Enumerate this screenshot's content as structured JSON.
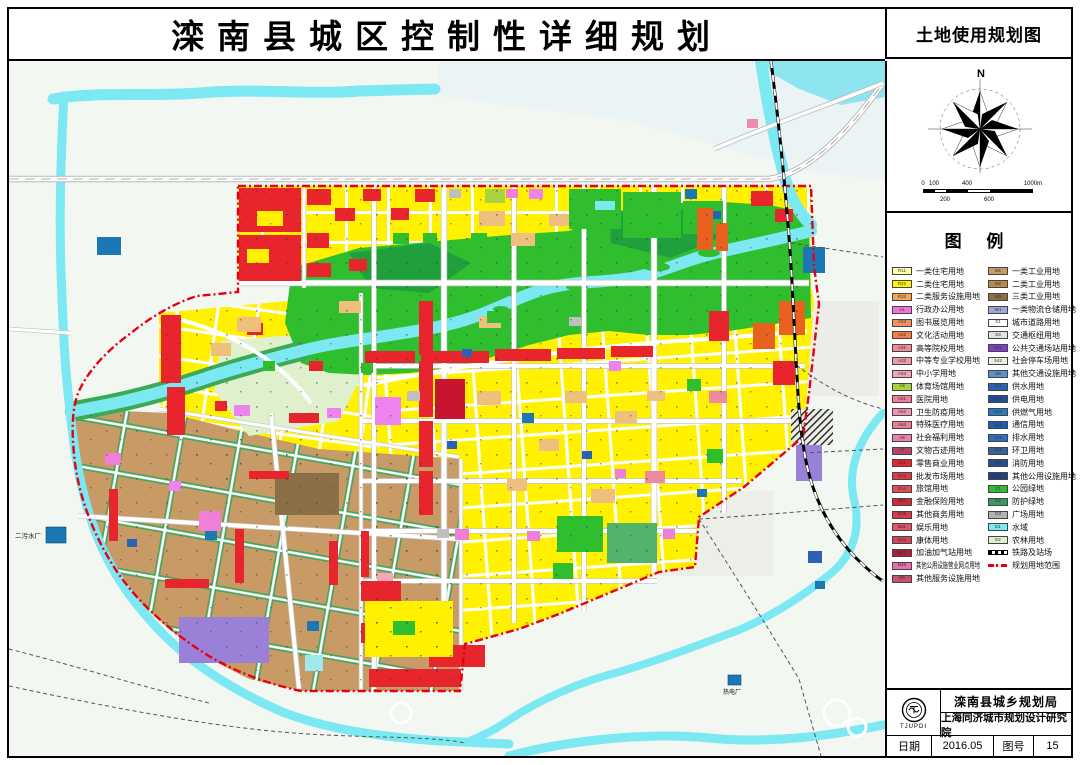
{
  "title": {
    "main": "滦南县城区控制性详细规划",
    "sub": "土地使用规划图"
  },
  "compass": {
    "north_label": "N"
  },
  "scale_bar": {
    "top_labels": [
      "0",
      "100",
      "400",
      "1000m"
    ],
    "bottom_labels": [
      "200",
      "600"
    ]
  },
  "legend": {
    "title": "图 例",
    "left_column": [
      {
        "code": "R11",
        "label": "一类住宅用地",
        "color": "#FFFFA8"
      },
      {
        "code": "R21",
        "label": "二类住宅用地",
        "color": "#FFF100"
      },
      {
        "code": "R22",
        "label": "二类服务设施用地",
        "color": "#F7A159"
      },
      {
        "code": "A1",
        "label": "行政办公用地",
        "color": "#F473D8"
      },
      {
        "code": "A23",
        "label": "图书展览用地",
        "color": "#F2925A"
      },
      {
        "code": "A22",
        "label": "文化活动用地",
        "color": "#F08146"
      },
      {
        "code": "A31",
        "label": "高等院校用地",
        "color": "#ED8A9C"
      },
      {
        "code": "A32",
        "label": "中等专业学校用地",
        "color": "#EF9AAB"
      },
      {
        "code": "A33",
        "label": "中小学用地",
        "color": "#F2A4B4"
      },
      {
        "code": "A4",
        "label": "体育场馆用地",
        "color": "#A8D23F"
      },
      {
        "code": "A51",
        "label": "医院用地",
        "color": "#EE7F9B"
      },
      {
        "code": "A52",
        "label": "卫生防疫用地",
        "color": "#F193B0"
      },
      {
        "code": "A53",
        "label": "特殊医疗用地",
        "color": "#E87F95"
      },
      {
        "code": "A6",
        "label": "社会福利用地",
        "color": "#EE7FAE"
      },
      {
        "code": "A7",
        "label": "文物古迹用地",
        "color": "#B5446B"
      },
      {
        "code": "B11",
        "label": "零售商业用地",
        "color": "#E8242D"
      },
      {
        "code": "B12",
        "label": "批发市场用地",
        "color": "#E03A42"
      },
      {
        "code": "B14",
        "label": "旅馆用地",
        "color": "#E04F57"
      },
      {
        "code": "B21",
        "label": "金融保险用地",
        "color": "#CE2A38"
      },
      {
        "code": "B29",
        "label": "其他商务用地",
        "color": "#D43A50"
      },
      {
        "code": "B31",
        "label": "娱乐用地",
        "color": "#E05568"
      },
      {
        "code": "B32",
        "label": "康体用地",
        "color": "#D94158"
      },
      {
        "code": "B41",
        "label": "加油加气站用地",
        "color": "#A62238"
      },
      {
        "code": "B49",
        "label": "其他公用设施营业网点用地",
        "color": "#E96FB2"
      },
      {
        "code": "B9",
        "label": "其他服务设施用地",
        "color": "#C94F6E"
      }
    ],
    "right_column": [
      {
        "code": "M1",
        "label": "一类工业用地",
        "color": "#C79A66"
      },
      {
        "code": "M2",
        "label": "二类工业用地",
        "color": "#B98A4F"
      },
      {
        "code": "M3",
        "label": "三类工业用地",
        "color": "#8B6F47"
      },
      {
        "code": "W1",
        "label": "一类物流仓储用地",
        "color": "#9FA8DA"
      },
      {
        "code": "S1",
        "label": "城市道路用地",
        "color": "#FFFFFF"
      },
      {
        "code": "S3",
        "label": "交通枢纽用地",
        "color": "#E2E2E2"
      },
      {
        "code": "S41",
        "label": "公共交通场站用地",
        "color": "#7D3FC9"
      },
      {
        "code": "S42",
        "label": "社会停车场用地",
        "color": "#F2EFE2"
      },
      {
        "code": "S9",
        "label": "其他交通设施用地",
        "color": "#5E8FD0"
      },
      {
        "code": "U11",
        "label": "供水用地",
        "color": "#2A63B5"
      },
      {
        "code": "U12",
        "label": "供电用地",
        "color": "#1D4F9E"
      },
      {
        "code": "U13",
        "label": "供燃气用地",
        "color": "#2A7AC4"
      },
      {
        "code": "U15",
        "label": "通信用地",
        "color": "#1F5FB0"
      },
      {
        "code": "U21",
        "label": "排水用地",
        "color": "#2F6FBE"
      },
      {
        "code": "U22",
        "label": "环卫用地",
        "color": "#35649C"
      },
      {
        "code": "U31",
        "label": "消防用地",
        "color": "#274F8E"
      },
      {
        "code": "U9",
        "label": "其他公用设施用地",
        "color": "#1F3F7E"
      },
      {
        "code": "G1",
        "label": "公园绿地",
        "color": "#2EBE2E"
      },
      {
        "code": "G2",
        "label": "防护绿地",
        "color": "#3C9A5F"
      },
      {
        "code": "G3",
        "label": "广场用地",
        "color": "#B3B3B3"
      },
      {
        "code": "E1",
        "label": "水域",
        "color": "#7CE8F2"
      },
      {
        "code": "E2",
        "label": "农林用地",
        "color": "#DFF0CC"
      },
      {
        "symbol": "railway",
        "label": "铁路及站场"
      },
      {
        "symbol": "boundary",
        "label": "规划用地范围"
      }
    ]
  },
  "map_labels": {
    "sewage_plant": "二污水厂",
    "power_plant": "热电厂"
  },
  "info_box": {
    "logo_text": "TJUPDI",
    "org1": "滦南县城乡规划局",
    "org2": "上海同济城市规划设计研究院",
    "date_label": "日期",
    "date_value": "2016.05",
    "sheet_label": "图号",
    "sheet_value": "15"
  },
  "colors": {
    "boundary": "#E60012",
    "water": "#7CE8F2",
    "park": "#2EBE2E",
    "residential": "#FFF100",
    "residential_pale": "#FFFFA8",
    "industrial": "#C79A66",
    "commercial": "#E8242D",
    "farmland": "#DFF0CC"
  }
}
